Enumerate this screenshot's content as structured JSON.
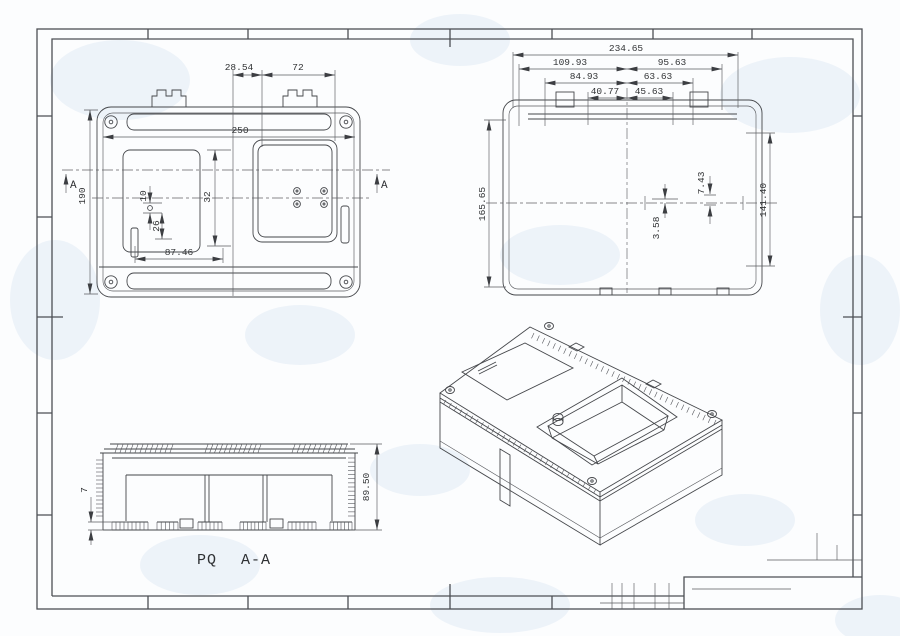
{
  "dims": {
    "lid": {
      "d28_54": "28.54",
      "d72": "72",
      "d250": "250",
      "d190": "190",
      "d87_46": "87.46",
      "d32": "32",
      "d10": "10",
      "d26": "26"
    },
    "base": {
      "d234_65": "234.65",
      "d109_93": "109.93",
      "d95_63": "95.63",
      "d84_93": "84.93",
      "d63_63": "63.63",
      "d40_77": "40.77",
      "d45_63": "45.63",
      "d165_65": "165.65",
      "d141_40": "141.40",
      "d7_43": "7.43",
      "d3_58": "3.58"
    },
    "section": {
      "d89_50": "89.50",
      "d7": "7"
    }
  },
  "labels": {
    "section_view_name": "PQ",
    "section_view_cut": "A-A",
    "section_marker": "A"
  },
  "colors": {
    "line": "#45474b",
    "frame": "#4c4f54",
    "background": "#fcfdfe",
    "watermark": "#dce7f3"
  }
}
